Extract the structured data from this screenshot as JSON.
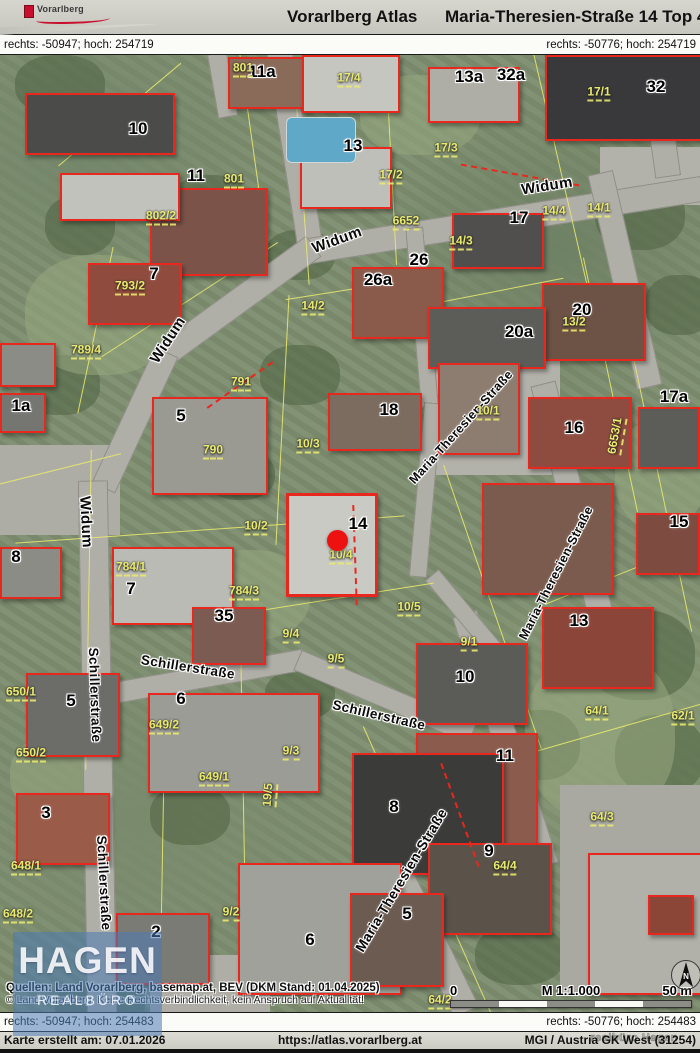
{
  "header": {
    "logo_text": "Vorarlberg",
    "app_title": "Vorarlberg Atlas",
    "page_title": "Maria-Theresien-Straße 14 Top 4"
  },
  "coordbars": {
    "top_left": "rechts: -50947; hoch: 254719",
    "top_right": "rechts: -50776; hoch: 254719",
    "bottom_left": "rechts: -50947; hoch: 254483",
    "bottom_right": "rechts: -50776; hoch: 254483"
  },
  "footer": {
    "created": "Karte erstellt am: 07.01.2026",
    "url": "https://atlas.vorarlberg.at",
    "crs": "MGI / Austria GK West (31254)",
    "watermark": "realbüro Hagen"
  },
  "map": {
    "attribution_line1": "Quellen: Land Vorarlberg, basemap.at, BEV (DKM Stand: 01.04.2025)",
    "attribution_line2": "© Land Vorarlberg, Keine Rechtsverbindlichkeit, kein Anspruch auf Aktualität!",
    "scalebar": {
      "zero": "0",
      "scale": "M 1:1.000",
      "distance": "50 m"
    },
    "north_label": "N",
    "watermark": {
      "line1": "HAGEN",
      "line2": "REALBÜRO"
    },
    "marker": {
      "x": 337,
      "y": 485,
      "color": "#ee1111"
    },
    "street_labels": [
      {
        "text": "Widum",
        "x": 547,
        "y": 131,
        "rot": -9,
        "size": 15
      },
      {
        "text": "Widum",
        "x": 337,
        "y": 185,
        "rot": -20,
        "size": 15
      },
      {
        "text": "Widum",
        "x": 168,
        "y": 285,
        "rot": -57,
        "size": 15
      },
      {
        "text": "Widum",
        "x": 86,
        "y": 467,
        "rot": 87,
        "size": 15
      },
      {
        "text": "Maria-Theresien-Straße",
        "x": 461,
        "y": 372,
        "rot": -48,
        "size": 12.5
      },
      {
        "text": "Maria-Theresien-Straße",
        "x": 556,
        "y": 518,
        "rot": -63,
        "size": 12.5
      },
      {
        "text": "Maria-Theresien-Straße",
        "x": 401,
        "y": 825,
        "rot": -59,
        "size": 14
      },
      {
        "text": "Schillerstraße",
        "x": 188,
        "y": 612,
        "rot": 9,
        "size": 13.5
      },
      {
        "text": "Schillerstraße",
        "x": 95,
        "y": 640,
        "rot": 88,
        "size": 13.5
      },
      {
        "text": "Schillerstraße",
        "x": 379,
        "y": 660,
        "rot": 13,
        "size": 13.5
      },
      {
        "text": "Schillerstraße",
        "x": 104,
        "y": 828,
        "rot": 87,
        "size": 13.5
      }
    ],
    "house_numbers": [
      {
        "text": "10",
        "x": 138,
        "y": 74
      },
      {
        "text": "11a",
        "x": 262,
        "y": 17
      },
      {
        "text": "11",
        "x": 196,
        "y": 121
      },
      {
        "text": "13",
        "x": 353,
        "y": 91
      },
      {
        "text": "13a",
        "x": 469,
        "y": 22
      },
      {
        "text": "32a",
        "x": 511,
        "y": 20
      },
      {
        "text": "32",
        "x": 656,
        "y": 32
      },
      {
        "text": "17",
        "x": 519,
        "y": 163
      },
      {
        "text": "26",
        "x": 419,
        "y": 205
      },
      {
        "text": "26a",
        "x": 378,
        "y": 225
      },
      {
        "text": "7",
        "x": 154,
        "y": 219
      },
      {
        "text": "20",
        "x": 582,
        "y": 255
      },
      {
        "text": "20a",
        "x": 519,
        "y": 277
      },
      {
        "text": "1a",
        "x": 21,
        "y": 351
      },
      {
        "text": "5",
        "x": 181,
        "y": 361
      },
      {
        "text": "18",
        "x": 389,
        "y": 355
      },
      {
        "text": "16",
        "x": 574,
        "y": 373
      },
      {
        "text": "17a",
        "x": 674,
        "y": 342
      },
      {
        "text": "15",
        "x": 679,
        "y": 467
      },
      {
        "text": "14",
        "x": 358,
        "y": 469
      },
      {
        "text": "8",
        "x": 16,
        "y": 502
      },
      {
        "text": "7",
        "x": 131,
        "y": 534
      },
      {
        "text": "35",
        "x": 224,
        "y": 561
      },
      {
        "text": "13",
        "x": 579,
        "y": 566
      },
      {
        "text": "5",
        "x": 71,
        "y": 646
      },
      {
        "text": "6",
        "x": 181,
        "y": 644
      },
      {
        "text": "10",
        "x": 465,
        "y": 622
      },
      {
        "text": "11",
        "x": 505,
        "y": 701
      },
      {
        "text": "8",
        "x": 394,
        "y": 752
      },
      {
        "text": "3",
        "x": 46,
        "y": 758
      },
      {
        "text": "9",
        "x": 489,
        "y": 796
      },
      {
        "text": "5",
        "x": 407,
        "y": 859
      },
      {
        "text": "2",
        "x": 156,
        "y": 877
      },
      {
        "text": "6",
        "x": 310,
        "y": 885
      }
    ],
    "parcel_labels": [
      {
        "text": "801",
        "x": 243,
        "y": 14
      },
      {
        "text": "17/4",
        "x": 349,
        "y": 24
      },
      {
        "text": "17/1",
        "x": 599,
        "y": 38
      },
      {
        "text": "17/3",
        "x": 446,
        "y": 94
      },
      {
        "text": "17/2",
        "x": 391,
        "y": 121
      },
      {
        "text": "801",
        "x": 234,
        "y": 125
      },
      {
        "text": "802/2",
        "x": 161,
        "y": 162
      },
      {
        "text": "6652",
        "x": 406,
        "y": 167
      },
      {
        "text": "14/4",
        "x": 554,
        "y": 157
      },
      {
        "text": "14/1",
        "x": 599,
        "y": 154
      },
      {
        "text": "14/3",
        "x": 461,
        "y": 187
      },
      {
        "text": "793/2",
        "x": 130,
        "y": 232
      },
      {
        "text": "14/2",
        "x": 313,
        "y": 252
      },
      {
        "text": "13/2",
        "x": 574,
        "y": 268
      },
      {
        "text": "789/4",
        "x": 86,
        "y": 296
      },
      {
        "text": "791",
        "x": 241,
        "y": 328
      },
      {
        "text": "10/1",
        "x": 488,
        "y": 357
      },
      {
        "text": "6653/1",
        "x": 616,
        "y": 381,
        "rot": -80
      },
      {
        "text": "10/3",
        "x": 308,
        "y": 390
      },
      {
        "text": "790",
        "x": 213,
        "y": 396
      },
      {
        "text": "10/2",
        "x": 256,
        "y": 472
      },
      {
        "text": "10/4",
        "x": 341,
        "y": 501
      },
      {
        "text": "784/1",
        "x": 131,
        "y": 513
      },
      {
        "text": "784/3",
        "x": 244,
        "y": 537
      },
      {
        "text": "10/5",
        "x": 409,
        "y": 553
      },
      {
        "text": "9/4",
        "x": 291,
        "y": 580
      },
      {
        "text": "9/1",
        "x": 469,
        "y": 588
      },
      {
        "text": "9/5",
        "x": 336,
        "y": 605
      },
      {
        "text": "650/1",
        "x": 21,
        "y": 638
      },
      {
        "text": "649/2",
        "x": 164,
        "y": 671
      },
      {
        "text": "64/1",
        "x": 597,
        "y": 657
      },
      {
        "text": "62/1",
        "x": 683,
        "y": 662
      },
      {
        "text": "9/3",
        "x": 291,
        "y": 697
      },
      {
        "text": "650/2",
        "x": 31,
        "y": 699
      },
      {
        "text": "649/1",
        "x": 214,
        "y": 723
      },
      {
        "text": "19/5",
        "x": 269,
        "y": 740,
        "rot": -85
      },
      {
        "text": "64/3",
        "x": 602,
        "y": 763
      },
      {
        "text": "64/4",
        "x": 505,
        "y": 812
      },
      {
        "text": "648/1",
        "x": 26,
        "y": 812
      },
      {
        "text": "9/2",
        "x": 231,
        "y": 858
      },
      {
        "text": "648/2",
        "x": 18,
        "y": 860
      },
      {
        "text": "64/2",
        "x": 440,
        "y": 946
      }
    ],
    "colors": {
      "cadastre_red": "#e8281e",
      "parcel_yellow": "#e9e96e",
      "road_gray": "#b0afa7",
      "watermark_blue": "rgba(74,122,181,0.55)"
    }
  }
}
